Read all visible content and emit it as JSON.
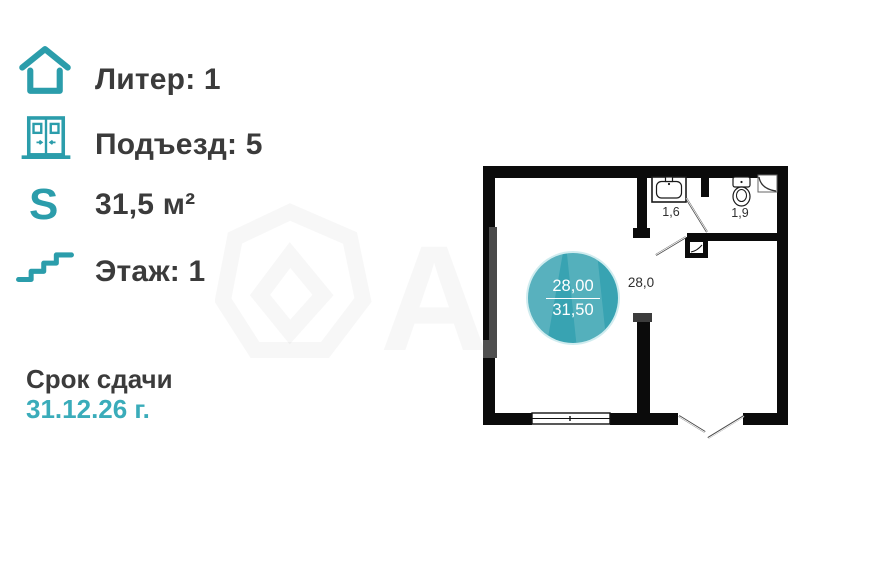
{
  "colors": {
    "accent": "#2b9dab",
    "accent_light": "#3aacba",
    "text_dark": "#3b3b3b",
    "badge_fill": "#38a3b2",
    "wall": "#0b0b0b"
  },
  "info_panel": {
    "rows": [
      {
        "id": "liter",
        "icon": "house-icon",
        "label": "Литер: 1"
      },
      {
        "id": "entrance",
        "icon": "doors-icon",
        "label": "Подъезд: 5"
      },
      {
        "id": "area",
        "icon": "area-s-icon",
        "label": "31,5 м²"
      },
      {
        "id": "floor",
        "icon": "stairs-icon",
        "label": "Этаж: 1"
      }
    ],
    "area_symbol": "S",
    "deadline_title": "Срок сдачи",
    "deadline_date": "31.12.26 г."
  },
  "floor_plan": {
    "room_labels": [
      {
        "id": "bathroom",
        "text": "1,6"
      },
      {
        "id": "wc",
        "text": "1,9"
      },
      {
        "id": "main",
        "text": "28,0"
      }
    ],
    "badge": {
      "living_area": "28,00",
      "total_area": "31,50"
    }
  }
}
